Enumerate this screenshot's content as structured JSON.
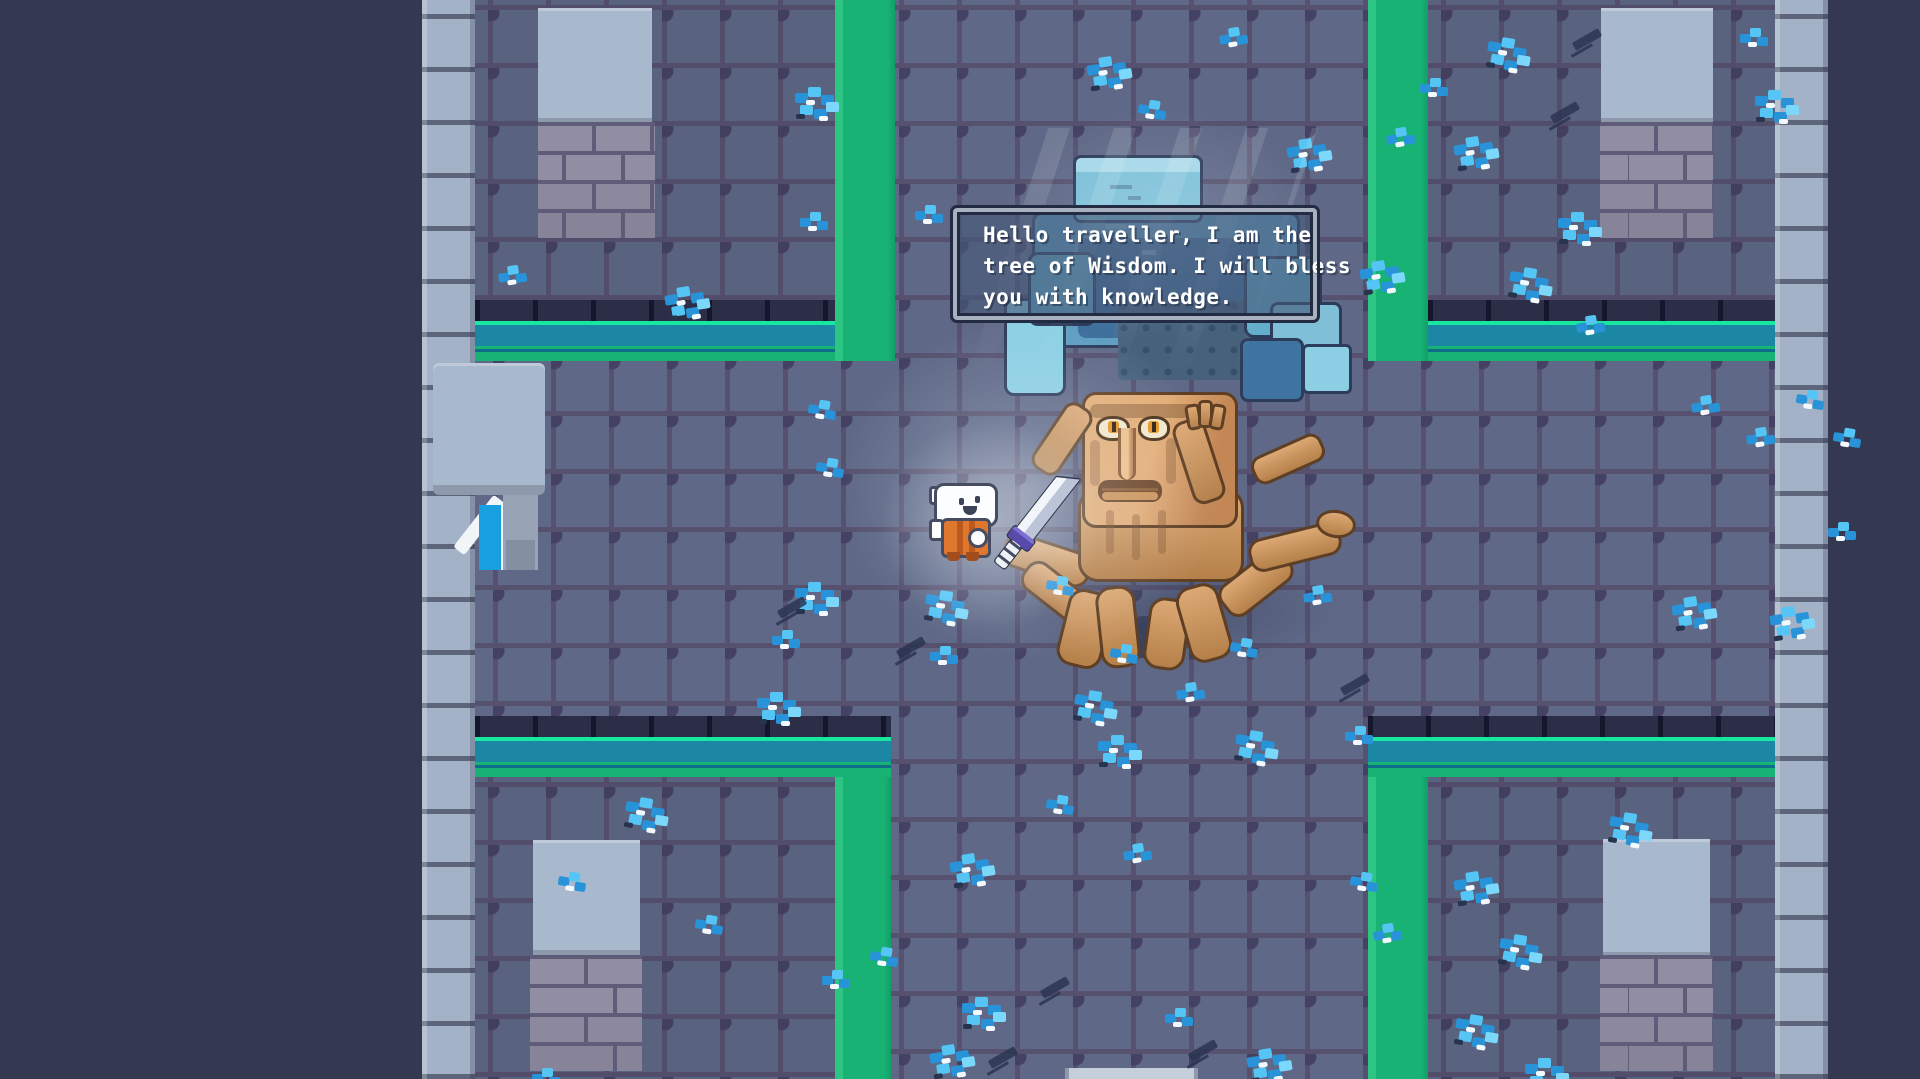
{
  "dialogue": {
    "lines": [
      "Hello traveller, I am the",
      "tree of Wisdom. I will bless",
      "you with knowledge."
    ],
    "full_text": "Hello traveller, I am the tree of Wisdom. I will bless you with knowledge.",
    "speaker": "Tree of Wisdom"
  },
  "entities": {
    "npc": "tree-of-wisdom",
    "player": "hero-with-sword"
  },
  "palette": {
    "outer_void": "#343851",
    "floor": "#5f6987",
    "room_floor": "#59627f",
    "grid_line": "#55516f",
    "wall_light": "#a3b2c6",
    "band_navy": "#2b2e46",
    "band_spring": "#18e89e",
    "band_teal": "#1b87a4",
    "path_green": "#18b275",
    "flower_blue": "#2893d8",
    "flower_light": "#54c5f5",
    "canopy_blue": "#5e9ec2",
    "canopy_dark": "#3f6f9c",
    "trunk_tan": "#dca873",
    "trunk_dark": "#5f3f24",
    "dialogue_fill": "rgba(70,88,120,0.62)",
    "dialogue_border": "#a8b1c0"
  },
  "scene": {
    "flowers": [
      [
        795,
        85,
        1
      ],
      [
        800,
        212,
        0
      ],
      [
        915,
        205,
        0
      ],
      [
        663,
        288,
        1
      ],
      [
        497,
        268,
        0
      ],
      [
        1085,
        58,
        1
      ],
      [
        1140,
        98,
        0
      ],
      [
        1285,
        140,
        1
      ],
      [
        1168,
        268,
        0
      ],
      [
        1358,
        262,
        1
      ],
      [
        1420,
        78,
        0
      ],
      [
        1085,
        268,
        0
      ],
      [
        1218,
        30,
        0
      ],
      [
        1490,
        33,
        1
      ],
      [
        1740,
        28,
        0
      ],
      [
        1755,
        88,
        1
      ],
      [
        1452,
        138,
        1
      ],
      [
        1558,
        210,
        1
      ],
      [
        1512,
        263,
        1
      ],
      [
        1385,
        130,
        0
      ],
      [
        1575,
        318,
        0
      ],
      [
        1690,
        398,
        0
      ],
      [
        1745,
        430,
        0
      ],
      [
        1798,
        388,
        0
      ],
      [
        1835,
        426,
        0
      ],
      [
        1828,
        522,
        0
      ],
      [
        1670,
        598,
        1
      ],
      [
        1768,
        608,
        1
      ],
      [
        810,
        398,
        0
      ],
      [
        818,
        456,
        0
      ],
      [
        795,
        580,
        1
      ],
      [
        772,
        630,
        0
      ],
      [
        928,
        586,
        1
      ],
      [
        930,
        646,
        0
      ],
      [
        757,
        690,
        1
      ],
      [
        1077,
        686,
        1
      ],
      [
        1175,
        685,
        0
      ],
      [
        1098,
        733,
        1
      ],
      [
        1238,
        726,
        1
      ],
      [
        1345,
        726,
        0
      ],
      [
        1048,
        793,
        0
      ],
      [
        1122,
        846,
        0
      ],
      [
        948,
        855,
        1
      ],
      [
        872,
        945,
        0
      ],
      [
        962,
        995,
        1
      ],
      [
        928,
        1046,
        1
      ],
      [
        1165,
        1008,
        0
      ],
      [
        1245,
        1050,
        1
      ],
      [
        1352,
        870,
        0
      ],
      [
        1372,
        926,
        0
      ],
      [
        1452,
        873,
        1
      ],
      [
        1502,
        930,
        1
      ],
      [
        1612,
        808,
        1
      ],
      [
        1458,
        1010,
        1
      ],
      [
        1525,
        1056,
        1
      ],
      [
        628,
        793,
        1
      ],
      [
        560,
        870,
        0
      ],
      [
        697,
        913,
        0
      ],
      [
        822,
        970,
        0
      ],
      [
        532,
        1068,
        0
      ]
    ],
    "flowers_front": [
      [
        1048,
        574,
        0
      ],
      [
        1112,
        642,
        0
      ],
      [
        1232,
        636,
        0
      ],
      [
        1302,
        588,
        0
      ]
    ],
    "cracks": [
      [
        777,
        603
      ],
      [
        896,
        643
      ],
      [
        1550,
        108
      ],
      [
        1572,
        35
      ],
      [
        1040,
        983
      ],
      [
        988,
        1053
      ],
      [
        1188,
        1046
      ],
      [
        1340,
        680
      ]
    ]
  }
}
